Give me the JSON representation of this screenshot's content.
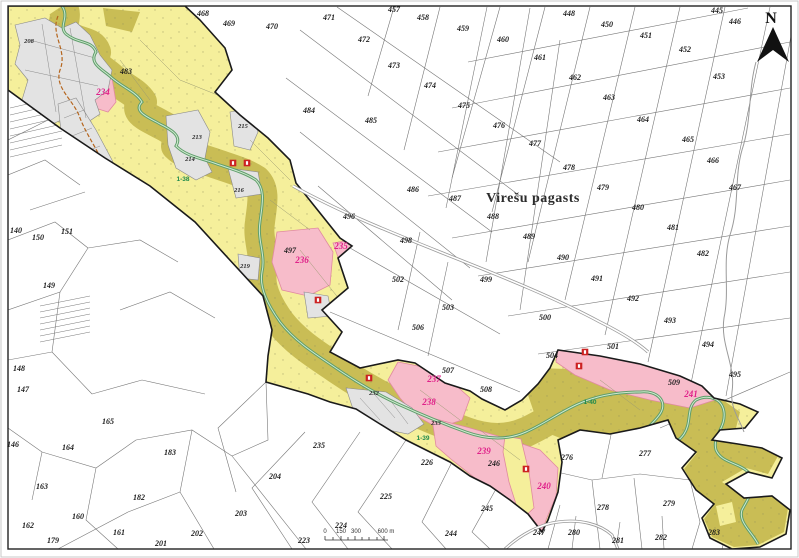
{
  "map": {
    "title": "Virešu pagasts",
    "north_label": "N",
    "scale_bar": {
      "tick_labels": [
        "0",
        "150",
        "300",
        "600 m"
      ]
    },
    "colors": {
      "yellow_zone": "#f5ef9b",
      "olive_zone": "#c9bd55",
      "pink_zone": "#f7bcca",
      "pink_zone_border": "#e08aa0",
      "magenta_label": "#e0218a",
      "settlement_fill": "#e3e3e3",
      "settlement_line": "#8a8a8a",
      "river": "#5f9e6b",
      "river_light": "#cfe9cf",
      "river_label": "#1f8a4c",
      "road_dashed": "#b5651d",
      "road_gray": "#9a9a9a",
      "marker_red": "#cc2222",
      "parcel_line": "#777777",
      "boundary": "#1a1a1a"
    },
    "white_parcels": [
      {
        "n": "445",
        "x": 717,
        "y": 13
      },
      {
        "n": "446",
        "x": 735,
        "y": 24
      },
      {
        "n": "448",
        "x": 569,
        "y": 16
      },
      {
        "n": "450",
        "x": 607,
        "y": 27
      },
      {
        "n": "451",
        "x": 646,
        "y": 38
      },
      {
        "n": "452",
        "x": 685,
        "y": 52
      },
      {
        "n": "453",
        "x": 719,
        "y": 79
      },
      {
        "n": "457",
        "x": 394,
        "y": 12
      },
      {
        "n": "458",
        "x": 423,
        "y": 20
      },
      {
        "n": "459",
        "x": 463,
        "y": 31
      },
      {
        "n": "460",
        "x": 503,
        "y": 42
      },
      {
        "n": "461",
        "x": 540,
        "y": 60
      },
      {
        "n": "462",
        "x": 575,
        "y": 80
      },
      {
        "n": "463",
        "x": 609,
        "y": 100
      },
      {
        "n": "464",
        "x": 643,
        "y": 122
      },
      {
        "n": "465",
        "x": 688,
        "y": 142
      },
      {
        "n": "466",
        "x": 713,
        "y": 163
      },
      {
        "n": "467",
        "x": 735,
        "y": 190
      },
      {
        "n": "468",
        "x": 203,
        "y": 16
      },
      {
        "n": "469",
        "x": 229,
        "y": 26
      },
      {
        "n": "470",
        "x": 272,
        "y": 29
      },
      {
        "n": "471",
        "x": 329,
        "y": 20
      },
      {
        "n": "472",
        "x": 364,
        "y": 42
      },
      {
        "n": "473",
        "x": 394,
        "y": 68
      },
      {
        "n": "474",
        "x": 430,
        "y": 88
      },
      {
        "n": "475",
        "x": 464,
        "y": 108
      },
      {
        "n": "476",
        "x": 499,
        "y": 128
      },
      {
        "n": "477",
        "x": 535,
        "y": 146
      },
      {
        "n": "478",
        "x": 569,
        "y": 170
      },
      {
        "n": "479",
        "x": 603,
        "y": 190
      },
      {
        "n": "480",
        "x": 638,
        "y": 210
      },
      {
        "n": "481",
        "x": 673,
        "y": 230
      },
      {
        "n": "482",
        "x": 703,
        "y": 256
      },
      {
        "n": "483",
        "x": 126,
        "y": 74
      },
      {
        "n": "484",
        "x": 309,
        "y": 113
      },
      {
        "n": "485",
        "x": 371,
        "y": 123
      },
      {
        "n": "486",
        "x": 413,
        "y": 192
      },
      {
        "n": "487",
        "x": 455,
        "y": 201
      },
      {
        "n": "488",
        "x": 493,
        "y": 219
      },
      {
        "n": "489",
        "x": 529,
        "y": 239
      },
      {
        "n": "490",
        "x": 563,
        "y": 260
      },
      {
        "n": "491",
        "x": 597,
        "y": 281
      },
      {
        "n": "492",
        "x": 633,
        "y": 301
      },
      {
        "n": "493",
        "x": 670,
        "y": 323
      },
      {
        "n": "494",
        "x": 708,
        "y": 347
      },
      {
        "n": "495",
        "x": 735,
        "y": 377
      },
      {
        "n": "496",
        "x": 349,
        "y": 219
      },
      {
        "n": "497",
        "x": 290,
        "y": 253
      },
      {
        "n": "498",
        "x": 406,
        "y": 243
      },
      {
        "n": "499",
        "x": 486,
        "y": 282
      },
      {
        "n": "500",
        "x": 545,
        "y": 320
      },
      {
        "n": "501",
        "x": 613,
        "y": 349
      },
      {
        "n": "502",
        "x": 398,
        "y": 282
      },
      {
        "n": "503",
        "x": 448,
        "y": 310
      },
      {
        "n": "504",
        "x": 552,
        "y": 358
      },
      {
        "n": "506",
        "x": 418,
        "y": 330
      },
      {
        "n": "507",
        "x": 448,
        "y": 373
      },
      {
        "n": "508",
        "x": 486,
        "y": 392
      },
      {
        "n": "509",
        "x": 674,
        "y": 385
      },
      {
        "n": "140",
        "x": 16,
        "y": 233
      },
      {
        "n": "146",
        "x": 13,
        "y": 447
      },
      {
        "n": "147",
        "x": 23,
        "y": 392
      },
      {
        "n": "148",
        "x": 19,
        "y": 371
      },
      {
        "n": "149",
        "x": 49,
        "y": 288
      },
      {
        "n": "150",
        "x": 38,
        "y": 240
      },
      {
        "n": "151",
        "x": 67,
        "y": 234
      },
      {
        "n": "160",
        "x": 78,
        "y": 519
      },
      {
        "n": "161",
        "x": 119,
        "y": 535
      },
      {
        "n": "162",
        "x": 28,
        "y": 528
      },
      {
        "n": "163",
        "x": 42,
        "y": 489
      },
      {
        "n": "164",
        "x": 68,
        "y": 450
      },
      {
        "n": "165",
        "x": 108,
        "y": 424
      },
      {
        "n": "179",
        "x": 53,
        "y": 543
      },
      {
        "n": "182",
        "x": 139,
        "y": 500
      },
      {
        "n": "183",
        "x": 170,
        "y": 455
      },
      {
        "n": "201",
        "x": 161,
        "y": 546
      },
      {
        "n": "202",
        "x": 197,
        "y": 536
      },
      {
        "n": "203",
        "x": 241,
        "y": 516
      },
      {
        "n": "204",
        "x": 275,
        "y": 479
      },
      {
        "n": "223",
        "x": 304,
        "y": 543
      },
      {
        "n": "224",
        "x": 341,
        "y": 528
      },
      {
        "n": "225",
        "x": 386,
        "y": 499
      },
      {
        "n": "226",
        "x": 427,
        "y": 465
      },
      {
        "n": "235",
        "x": 319,
        "y": 448
      },
      {
        "n": "244",
        "x": 451,
        "y": 536
      },
      {
        "n": "245",
        "x": 487,
        "y": 511
      },
      {
        "n": "246",
        "x": 494,
        "y": 466
      },
      {
        "n": "247",
        "x": 539,
        "y": 535
      },
      {
        "n": "276",
        "x": 567,
        "y": 460
      },
      {
        "n": "277",
        "x": 645,
        "y": 456
      },
      {
        "n": "278",
        "x": 603,
        "y": 510
      },
      {
        "n": "279",
        "x": 669,
        "y": 506
      },
      {
        "n": "280",
        "x": 574,
        "y": 535
      },
      {
        "n": "281",
        "x": 618,
        "y": 543
      },
      {
        "n": "282",
        "x": 661,
        "y": 540
      },
      {
        "n": "283",
        "x": 714,
        "y": 535
      }
    ],
    "settlement_parcels": [
      {
        "n": "208",
        "x": 29,
        "y": 43
      },
      {
        "n": "213",
        "x": 197,
        "y": 139
      },
      {
        "n": "214",
        "x": 190,
        "y": 161
      },
      {
        "n": "215",
        "x": 243,
        "y": 128
      },
      {
        "n": "216",
        "x": 239,
        "y": 192
      },
      {
        "n": "219",
        "x": 245,
        "y": 268
      },
      {
        "n": "232",
        "x": 374,
        "y": 395
      },
      {
        "n": "233",
        "x": 436,
        "y": 425
      }
    ],
    "zone_parcels": [
      {
        "n": "234",
        "x": 103,
        "y": 95
      },
      {
        "n": "235",
        "x": 341,
        "y": 249
      },
      {
        "n": "236",
        "x": 302,
        "y": 263
      },
      {
        "n": "237",
        "x": 434,
        "y": 382
      },
      {
        "n": "238",
        "x": 429,
        "y": 405
      },
      {
        "n": "239",
        "x": 484,
        "y": 454
      },
      {
        "n": "240",
        "x": 544,
        "y": 489
      },
      {
        "n": "241",
        "x": 691,
        "y": 397
      }
    ],
    "river_segments": [
      {
        "n": "1-38",
        "x": 183,
        "y": 181
      },
      {
        "n": "1-39",
        "x": 423,
        "y": 440
      },
      {
        "n": "1-40",
        "x": 590,
        "y": 404
      }
    ],
    "site_markers": [
      {
        "x": 233,
        "y": 163
      },
      {
        "x": 247,
        "y": 163
      },
      {
        "x": 318,
        "y": 300
      },
      {
        "x": 369,
        "y": 378
      },
      {
        "x": 579,
        "y": 366
      },
      {
        "x": 585,
        "y": 352
      },
      {
        "x": 526,
        "y": 469
      }
    ]
  }
}
